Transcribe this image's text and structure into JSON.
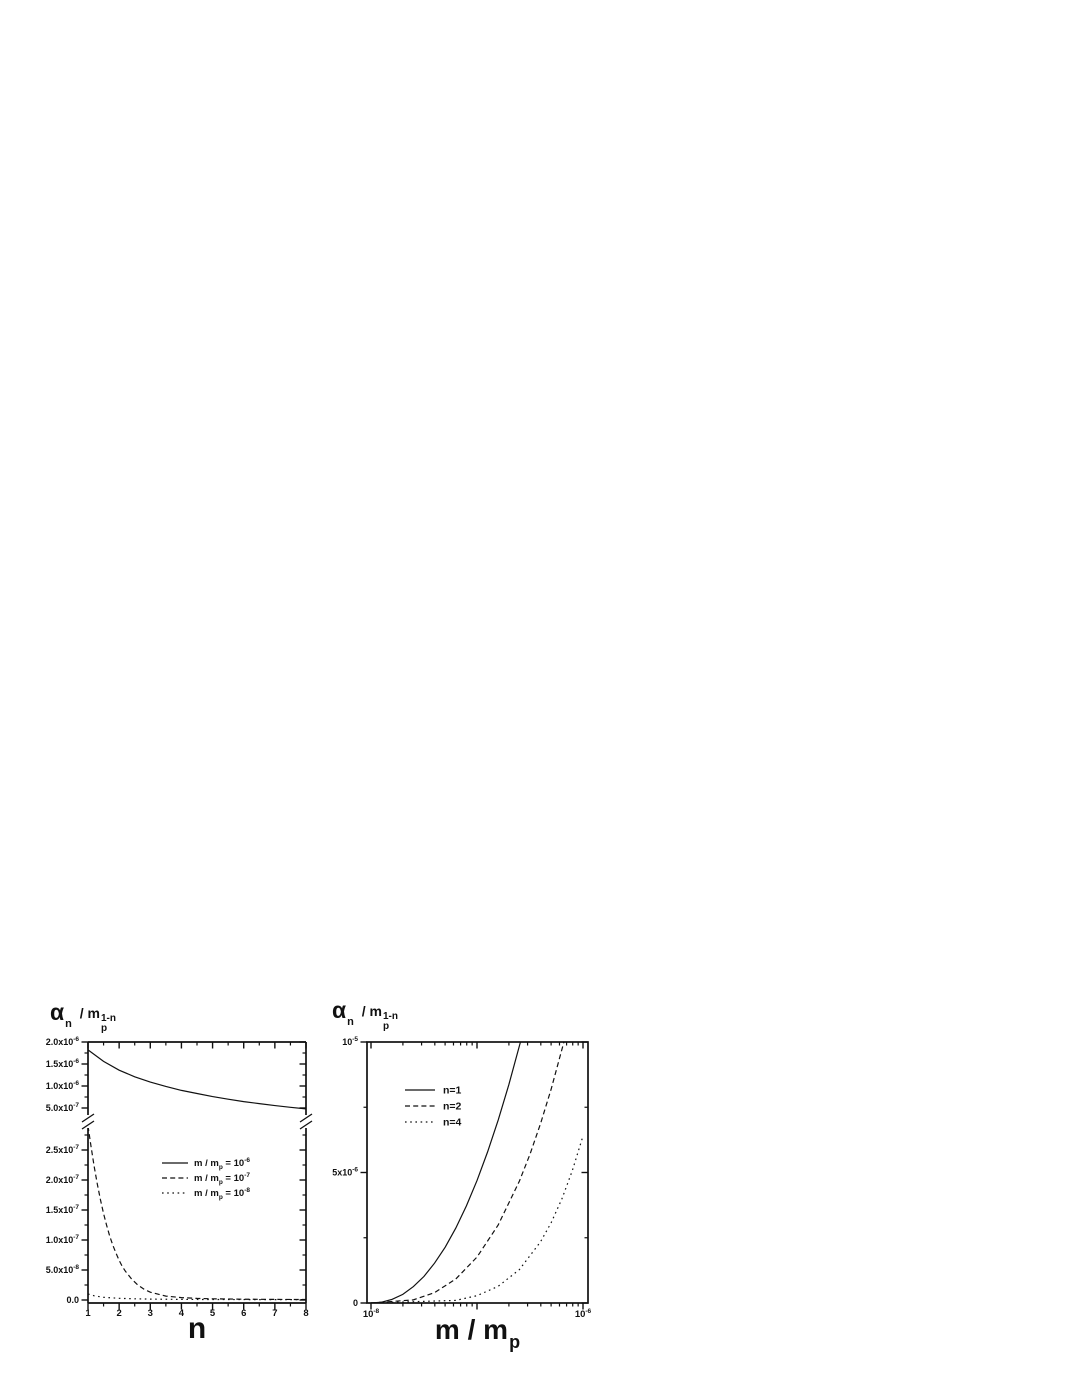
{
  "page": {
    "background": "#ffffff",
    "ink": "#111111"
  },
  "chart_data": [
    {
      "id": "left-plot",
      "type": "line",
      "title": "",
      "ylabel": "alpha_n / m_p^(1-n)",
      "ylabel_parts": {
        "symbol": "α",
        "symbol_sub": "n",
        "mid": " / m",
        "base_sub": "p",
        "base_sup": "1-n"
      },
      "xlabel": "n",
      "x_axis": {
        "scale": "linear",
        "range": [
          1,
          8
        ],
        "major_ticks": [
          1,
          2,
          3,
          4,
          5,
          6,
          7,
          8
        ],
        "minor_ticks": [
          1.5,
          2.5,
          3.5,
          4.5,
          5.5,
          6.5,
          7.5
        ]
      },
      "axis_break": true,
      "panels": [
        {
          "name": "upper",
          "ylim": [
            3.4e-07,
            2e-06
          ],
          "major_ticks": [
            {
              "value": 2e-06,
              "label": "2.0x10",
              "exp": "-6"
            },
            {
              "value": 1.5e-06,
              "label": "1.5x10",
              "exp": "-6"
            },
            {
              "value": 1e-06,
              "label": "1.0x10",
              "exp": "-6"
            },
            {
              "value": 5e-07,
              "label": "5.0x10",
              "exp": "-7"
            }
          ],
          "minor_ticks": [
            1.75e-06,
            1.25e-06,
            7.5e-07
          ]
        },
        {
          "name": "lower",
          "ylim": [
            -5e-09,
            2.87e-07
          ],
          "major_ticks": [
            {
              "value": 2.5e-07,
              "label": "2.5x10",
              "exp": "-7"
            },
            {
              "value": 2e-07,
              "label": "2.0x10",
              "exp": "-7"
            },
            {
              "value": 1.5e-07,
              "label": "1.5x10",
              "exp": "-7"
            },
            {
              "value": 1e-07,
              "label": "1.0x10",
              "exp": "-7"
            },
            {
              "value": 5e-08,
              "label": "5.0x10",
              "exp": "-8"
            },
            {
              "value": 0,
              "label": "0.0",
              "exp": ""
            }
          ],
          "minor_ticks": [
            2.75e-07,
            2.25e-07,
            1.75e-07,
            1.25e-07,
            7.5e-08,
            2.5e-08
          ]
        }
      ],
      "legend": {
        "entries": [
          {
            "dash": "solid",
            "pre": "m / m",
            "sub": "p",
            "mid": " = 10",
            "sup": "-6"
          },
          {
            "dash": "dashed",
            "pre": "m / m",
            "sub": "p",
            "mid": " = 10",
            "sup": "-7"
          },
          {
            "dash": "dotted",
            "pre": "m / m",
            "sub": "p",
            "mid": " = 10",
            "sup": "-8"
          }
        ]
      },
      "series": [
        {
          "name": "m/mp=10^-6",
          "dash": "solid",
          "panel": 0,
          "points": [
            [
              1,
              1.82e-06
            ],
            [
              1.5,
              1.56e-06
            ],
            [
              2,
              1.36e-06
            ],
            [
              2.5,
              1.21e-06
            ],
            [
              3,
              1.09e-06
            ],
            [
              3.5,
              9.9e-07
            ],
            [
              4,
              9e-07
            ],
            [
              4.5,
              8.3e-07
            ],
            [
              5,
              7.6e-07
            ],
            [
              5.5,
              7e-07
            ],
            [
              6,
              6.45e-07
            ],
            [
              6.5,
              6e-07
            ],
            [
              7,
              5.55e-07
            ],
            [
              7.5,
              5.15e-07
            ],
            [
              8,
              4.8e-07
            ]
          ]
        },
        {
          "name": "m/mp=10^-7",
          "dash": "dashed",
          "panel": 1,
          "points": [
            [
              1,
              2.9e-07
            ],
            [
              1.1,
              2.55e-07
            ],
            [
              1.2,
              2.22e-07
            ],
            [
              1.3,
              1.93e-07
            ],
            [
              1.4,
              1.67e-07
            ],
            [
              1.5,
              1.44e-07
            ],
            [
              1.6,
              1.24e-07
            ],
            [
              1.7,
              1.06e-07
            ],
            [
              1.8,
              9.1e-08
            ],
            [
              1.9,
              7.8e-08
            ],
            [
              2,
              6.6e-08
            ],
            [
              2.1,
              5.6e-08
            ],
            [
              2.2,
              4.8e-08
            ],
            [
              2.4,
              3.5e-08
            ],
            [
              2.6,
              2.5e-08
            ],
            [
              2.8,
              1.8e-08
            ],
            [
              3,
              1.3e-08
            ],
            [
              3.5,
              6.5e-09
            ],
            [
              4,
              4e-09
            ],
            [
              4.5,
              2.7e-09
            ],
            [
              5,
              2e-09
            ],
            [
              6,
              1.3e-09
            ],
            [
              7,
              1e-09
            ],
            [
              8,
              8e-10
            ]
          ]
        },
        {
          "name": "m/mp=10^-8",
          "dash": "dotted",
          "panel": 1,
          "points": [
            [
              1,
              1e-08
            ],
            [
              1.2,
              7e-09
            ],
            [
              1.5,
              4.5e-09
            ],
            [
              2,
              2.8e-09
            ],
            [
              2.5,
              2e-09
            ],
            [
              3,
              1.5e-09
            ],
            [
              4,
              1e-09
            ],
            [
              5,
              8e-10
            ],
            [
              6,
              7e-10
            ],
            [
              7,
              6e-10
            ],
            [
              8,
              6e-10
            ]
          ]
        }
      ]
    },
    {
      "id": "right-plot",
      "type": "line",
      "title": "",
      "ylabel": "alpha_n / m_p^(1-n)",
      "ylabel_parts": {
        "symbol": "α",
        "symbol_sub": "n",
        "mid": " / m",
        "base_sub": "p",
        "base_sup": "1-n"
      },
      "xlabel": "m / m_p",
      "xlabel_parts": {
        "pre": "m / m",
        "sub": "p"
      },
      "x_axis": {
        "scale": "log",
        "lim_log10": [
          -8,
          -6
        ],
        "major_ticks": [
          {
            "log": -8,
            "label": "10",
            "exp": "-8"
          },
          {
            "log": -7,
            "label": "",
            "exp": ""
          },
          {
            "log": -6,
            "label": "10",
            "exp": "-6"
          }
        ]
      },
      "y_axis": {
        "lim": [
          0,
          1e-05
        ],
        "major_ticks": [
          {
            "value": 1e-05,
            "label": "10",
            "exp": "-5"
          },
          {
            "value": 5e-06,
            "label": "5x10",
            "exp": "-6"
          },
          {
            "value": 0,
            "label": "0",
            "exp": ""
          }
        ],
        "minor_ticks": [
          7.5e-06,
          2.5e-06
        ]
      },
      "legend": {
        "entries": [
          {
            "dash": "solid",
            "pre": "n=1",
            "sub": "",
            "mid": "",
            "sup": ""
          },
          {
            "dash": "dashed",
            "pre": "n=2",
            "sub": "",
            "mid": "",
            "sup": ""
          },
          {
            "dash": "dotted",
            "pre": "n=4",
            "sub": "",
            "mid": "",
            "sup": ""
          }
        ]
      },
      "series": [
        {
          "name": "n=1",
          "dash": "solid",
          "points_logx": [
            [
              -8,
              0
            ],
            [
              -7.9,
              3e-08
            ],
            [
              -7.8,
              1.4e-07
            ],
            [
              -7.7,
              3.3e-07
            ],
            [
              -7.6,
              6.3e-07
            ],
            [
              -7.5,
              1.02e-06
            ],
            [
              -7.4,
              1.53e-06
            ],
            [
              -7.3,
              2.14e-06
            ],
            [
              -7.2,
              2.87e-06
            ],
            [
              -7.1,
              3.72e-06
            ],
            [
              -7.0,
              4.69e-06
            ],
            [
              -6.9,
              5.79e-06
            ],
            [
              -6.8,
              7.01e-06
            ],
            [
              -6.7,
              8.36e-06
            ],
            [
              -6.59,
              1e-05
            ]
          ]
        },
        {
          "name": "n=2",
          "dash": "dashed",
          "points_logx": [
            [
              -8,
              0
            ],
            [
              -7.6,
              1.2e-07
            ],
            [
              -7.4,
              4e-07
            ],
            [
              -7.2,
              9.2e-07
            ],
            [
              -7.0,
              1.76e-06
            ],
            [
              -6.8,
              2.99e-06
            ],
            [
              -6.6,
              4.67e-06
            ],
            [
              -6.5,
              5.7e-06
            ],
            [
              -6.4,
              6.88e-06
            ],
            [
              -6.3,
              8.2e-06
            ],
            [
              -6.18,
              1e-05
            ]
          ]
        },
        {
          "name": "n=4",
          "dash": "dotted",
          "points_logx": [
            [
              -8,
              0
            ],
            [
              -7.2,
              1e-07
            ],
            [
              -7.0,
              2.8e-07
            ],
            [
              -6.8,
              6.4e-07
            ],
            [
              -6.6,
              1.28e-06
            ],
            [
              -6.4,
              2.35e-06
            ],
            [
              -6.3,
              3.08e-06
            ],
            [
              -6.2,
              3.98e-06
            ],
            [
              -6.1,
              5.08e-06
            ],
            [
              -6.0,
              6.4e-06
            ]
          ]
        }
      ]
    }
  ]
}
